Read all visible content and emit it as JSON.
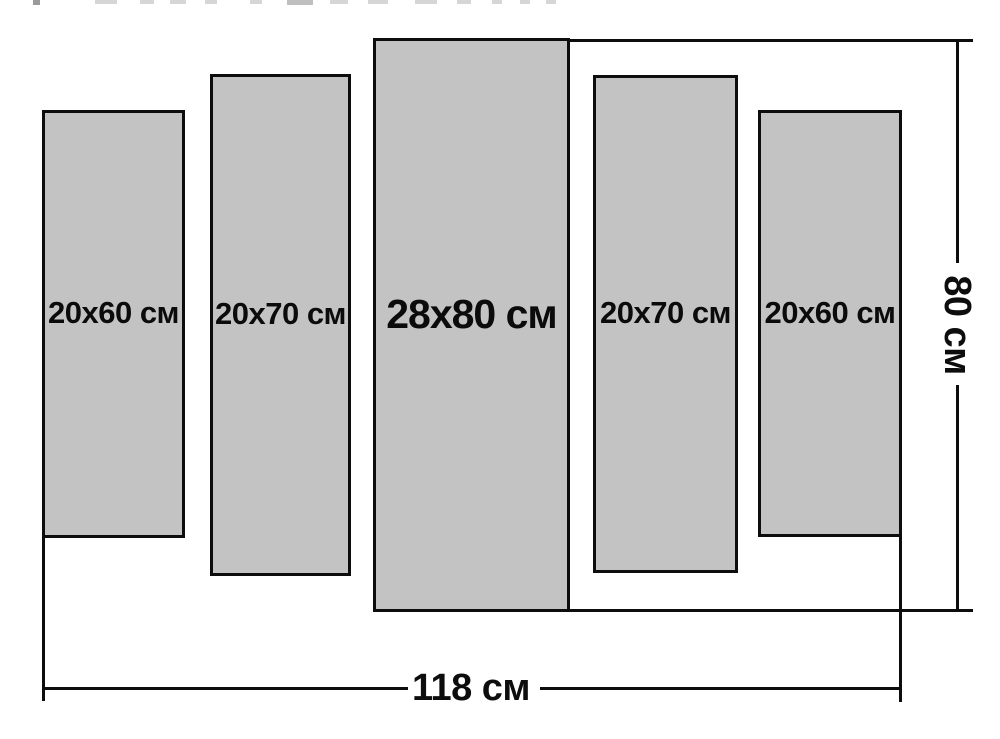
{
  "diagram": {
    "type": "modular-picture-size-diagram",
    "unit": "см",
    "panels": [
      {
        "position": "far-left",
        "label": "20x60 см",
        "width_cm": 20,
        "height_cm": 60
      },
      {
        "position": "left",
        "label": "20x70 см",
        "width_cm": 20,
        "height_cm": 70
      },
      {
        "position": "center",
        "label": "28x80 см",
        "width_cm": 28,
        "height_cm": 80
      },
      {
        "position": "right",
        "label": "20x70 см",
        "width_cm": 20,
        "height_cm": 70
      },
      {
        "position": "far-right",
        "label": "20x60 см",
        "width_cm": 20,
        "height_cm": 60
      }
    ],
    "dimensions": {
      "total_width_label": "118 см",
      "total_width_cm": 118,
      "total_height_label": "80 см",
      "total_height_cm": 80
    },
    "colors": {
      "background": "#ffffff",
      "panel_fill": "#c3c3c3",
      "panel_border": "#0d0d0d",
      "dimension_line": "#0d0d0d",
      "label_text": "#0b0b0b"
    },
    "artifacts": {
      "top_edge_cropped_text": "unreadable faint fragments"
    }
  }
}
